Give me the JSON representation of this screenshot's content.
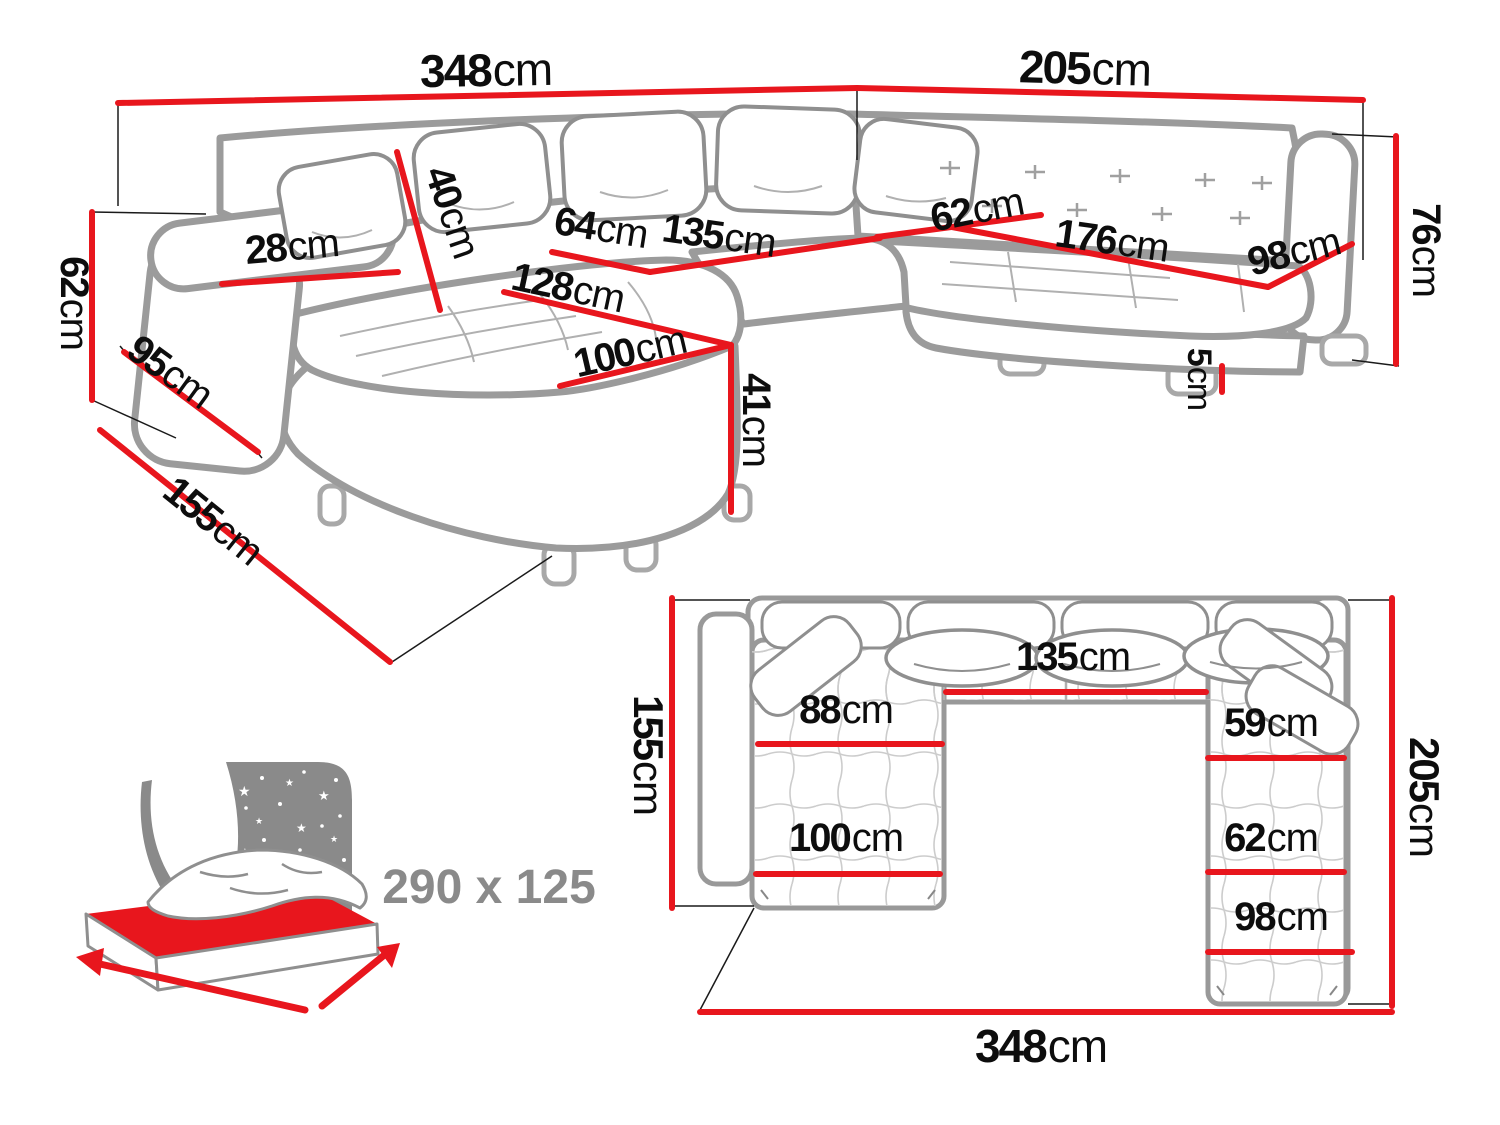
{
  "palette": {
    "dimension_red": "#e8161d",
    "sofa_outline_gray": "#9b9b9b",
    "detail_gray": "#b0b0b0",
    "icon_gray": "#8a8a8a",
    "label_color": "#0d0d0d",
    "background": "#ffffff"
  },
  "perspective_view": {
    "description": "u-shaped-corner-sofa-perspective-drawing",
    "dimensions": {
      "total_width": {
        "num": "348",
        "unit": "cm"
      },
      "right_depth": {
        "num": "205",
        "unit": "cm"
      },
      "back_cushion_height": {
        "num": "40",
        "unit": "cm"
      },
      "armrest_width": {
        "num": "28",
        "unit": "cm"
      },
      "seat_cushion_width": {
        "num": "64",
        "unit": "cm"
      },
      "center_seat_width": {
        "num": "135",
        "unit": "cm"
      },
      "right_seat_depth": {
        "num": "62",
        "unit": "cm"
      },
      "right_seat_length": {
        "num": "176",
        "unit": "cm"
      },
      "right_arm_span": {
        "num": "98",
        "unit": "cm"
      },
      "right_back_height": {
        "num": "76",
        "unit": "cm"
      },
      "left_side_height": {
        "num": "62",
        "unit": "cm"
      },
      "left_arm_depth": {
        "num": "95",
        "unit": "cm"
      },
      "chaise_depth": {
        "num": "155",
        "unit": "cm"
      },
      "chaise_length": {
        "num": "128",
        "unit": "cm"
      },
      "chaise_width": {
        "num": "100",
        "unit": "cm"
      },
      "seat_height": {
        "num": "41",
        "unit": "cm"
      },
      "leg_height": {
        "num": "5",
        "unit": "cm"
      }
    }
  },
  "top_view": {
    "description": "u-shaped-corner-sofa-top-view-drawing",
    "dimensions": {
      "left_depth": {
        "num": "155",
        "unit": "cm"
      },
      "right_depth": {
        "num": "205",
        "unit": "cm"
      },
      "total_width": {
        "num": "348",
        "unit": "cm"
      },
      "center_seat_width": {
        "num": "135",
        "unit": "cm"
      },
      "chaise_upper_width": {
        "num": "88",
        "unit": "cm"
      },
      "right_upper_width": {
        "num": "59",
        "unit": "cm"
      },
      "right_lower_width": {
        "num": "62",
        "unit": "cm"
      },
      "chaise_width": {
        "num": "100",
        "unit": "cm"
      },
      "right_section_width": {
        "num": "98",
        "unit": "cm"
      }
    }
  },
  "sleeping_function": {
    "icon": "sofa-bed-night-icon",
    "size_label": "290 x 125"
  }
}
